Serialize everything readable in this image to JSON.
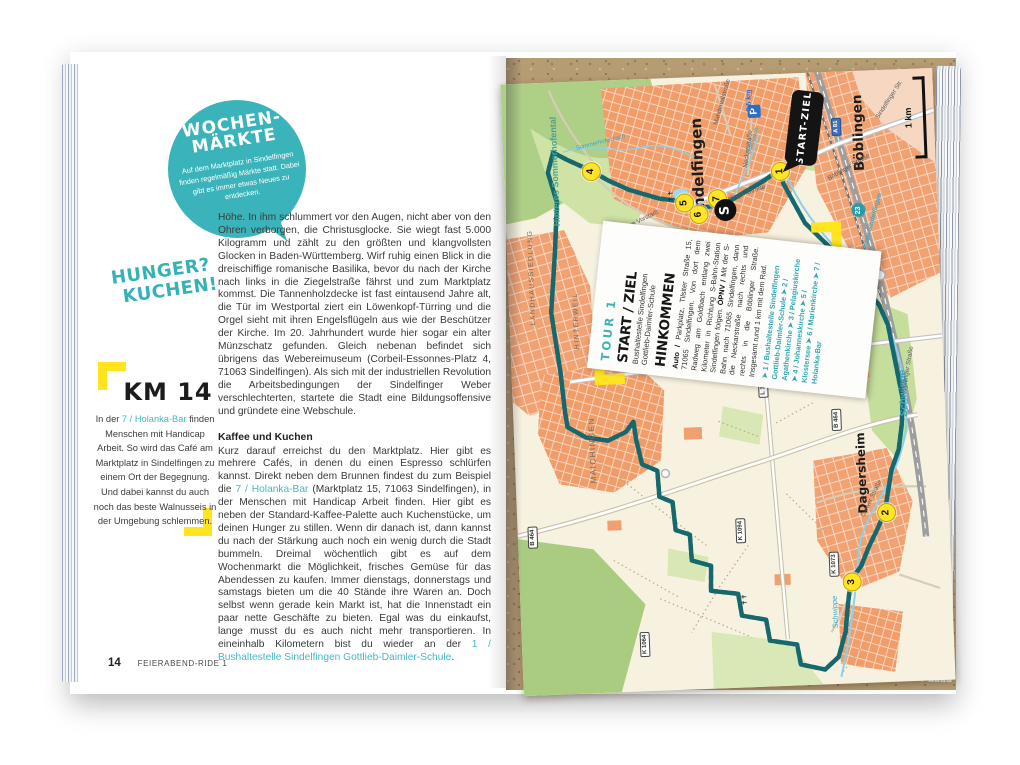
{
  "left_page": {
    "market_bubble": {
      "title_line1": "WOCHEN-",
      "title_line2": "MÄRKTE",
      "body": "Auf dem Marktplatz in Sindelfingen finden regelmäßig Märkte statt. Dabei gibt es immer etwas Neues zu entdecken."
    },
    "hunger_line1": "HUNGER?",
    "hunger_line2": "KUCHEN!",
    "km_block": {
      "title": "KM 14",
      "prefix": "In der ",
      "link": "7 / Holanka-Bar",
      "rest": " finden Menschen mit Handicap Arbeit. So wird das Café am Marktplatz in Sindelfingen zu einem Ort der Begegnung. Und dabei kannst du auch noch das beste Walnusseis in der Umgebung schlemmen."
    },
    "paragraph1": "Höhe. In ihm schlummert vor den Augen, nicht aber von den Ohren verborgen, die Christusglocke. Sie wiegt fast 5.000 Kilogramm und zählt zu den größten und klangvollsten Glocken in Baden-Württemberg. Wirf ruhig einen Blick in die dreischiffige romanische Basilika, bevor du nach der Kirche nach links in die Ziegelstraße fährst und zum Marktplatz kommst. Die Tannenholzdecke ist fast eintausend Jahre alt, die Tür im Westportal ziert ein Löwenkopf-Türring und die Orgel sieht mit ihren Engelsflügeln aus wie der Beschützer der Kirche. Im 20. Jahrhundert wurde hier sogar ein alter Münzschatz gefunden. Gleich nebenan befindet sich übrigens das Webereimuseum (Corbeil-Essonnes-Platz 4, 71063 Sindelfingen). Als sich mit der industriellen Revolution die Arbeitsbedingungen der Sindelfinger Weber verschlechterten, startete die Stadt eine Bildungsoffensive und gründete eine Webschule.",
    "section": {
      "heading": "Kaffee und Kuchen",
      "p2_part1": "Kurz darauf erreichst du den Marktplatz. Hier gibt es mehrere Cafés, in denen du einen Espresso schlürfen kannst. Direkt neben dem Brunnen findest du zum Beispiel die ",
      "p2_link1": "7 / Holanka-Bar",
      "p2_part2": " (Marktplatz 15, 71063 Sindelfingen), in der Menschen mit Handicap Arbeit finden. Hier gibt es neben der Standard-Kaffee-Palette auch Kuchenstücke, um deinen Hunger zu stillen. Wenn dir danach ist, dann kannst du nach der Stärkung auch noch ein wenig durch die Stadt bummeln. Dreimal wöchentlich gibt es auf dem Wochenmarkt die Möglichkeit, frisches Gemüse für das Abendessen zu kaufen. Immer dienstags, donnerstags und samstags bieten um die 40 Stände ihre Waren an. Doch selbst wenn gerade kein Markt ist, hat die Innenstadt ein paar nette Geschäfte zu bieten. Egal was du einkaufst, lange musst du es auch nicht mehr transportieren. In eineinhalb Kilometern bist du wieder an der ",
      "p2_link2": "1 / Bushaltestelle Sindelfingen Gottlieb-Daimler-Schule",
      "p2_end": "."
    },
    "footer": {
      "page_number": "14",
      "ride_title": "FEIERABEND-RIDE 1"
    }
  },
  "map": {
    "cities": {
      "sindelfingen": "Sindelfingen",
      "boeblingen": "Böblingen",
      "dagersheim": "Dagersheim",
      "maichingen": "MAICHINGEN"
    },
    "districts": {
      "landhaussiedlung": "LANDHAUSSIEDLUNG",
      "hinterweil": "HINTERWEIL",
      "sommerhofental": "Hinteres Sommerhofental"
    },
    "waters": {
      "schwippe": "Schwippe",
      "schwippe2": "Schwippe",
      "goldbach": "Goldbach",
      "sommerhofenbach": "Sommerhofenbach"
    },
    "streets": {
      "boeblinger1": "Böblinger Straße",
      "boeblinger2": "Böblinger Straße",
      "gottlieb": "Gottlieb-Daimler-Straße",
      "neckar": "Neckarstraße",
      "mahdental": "Mahdentalstraße",
      "obere_vorstadt": "Obere Vorstadt",
      "calwer": "Calwer Straße",
      "sindelfinger": "Sindelfinger Str.",
      "doeffinger": "Döffinger Straße"
    },
    "badges": {
      "a81": "A 81",
      "b464_w": "B 464",
      "b464_e": "B 464",
      "l1183": "L 1183",
      "k1094": "K 1094",
      "k1064": "K 1064",
      "k1073": "K 1073"
    },
    "markers": {
      "m1": "1",
      "m2": "2",
      "m3": "3",
      "m4": "4",
      "m5": "5",
      "m6": "6",
      "m7": "7",
      "sbahn": "S",
      "s23": "23"
    },
    "sbahn_line_label": "Böblingen Sindelfingen",
    "start_flag": "START-ZIEL",
    "parking": {
      "p": "P",
      "dist": "0.5 km",
      "arrow": "↑"
    },
    "scale_label": "1 km",
    "card": {
      "tour": "TOUR 1",
      "start_heading": "START / ZIEL",
      "start_line1": "Bushaltestelle Sindelfingen",
      "start_line2": "Gottlieb-Daimler-Schule",
      "hinkommen_heading": "HINKOMMEN",
      "auto_label": "Auto /",
      "auto_text": " Parkplatz, Tilsiter Straße 15, 71065 Sindelfingen. Von dort dem Radweg am Goldbach entlang zwei Kilometer in Richtung S-Bahn-Station Sindelfingen folgen. ",
      "opnv_label": "ÖPNV /",
      "opnv_text": " Mit der S-Bahn nach 71065 Sindelfingen, dann die Neckarstraße nach rechts und rechts in die Böblinger Straße. Insgesamt rund 1 km mit dem Rad.",
      "pois": "➤ 1 / Bushaltestelle Sindelfingen Gottlieb-Daimler-Schule ➤ 2 / Agathenkirche ➤ 3 / Pelagiuskirche ➤ 4 / Johanneskirche ➤ 5 / Klostersee ➤ 6 / Marienkirche ➤ 7 / Holanka-Bar"
    }
  }
}
